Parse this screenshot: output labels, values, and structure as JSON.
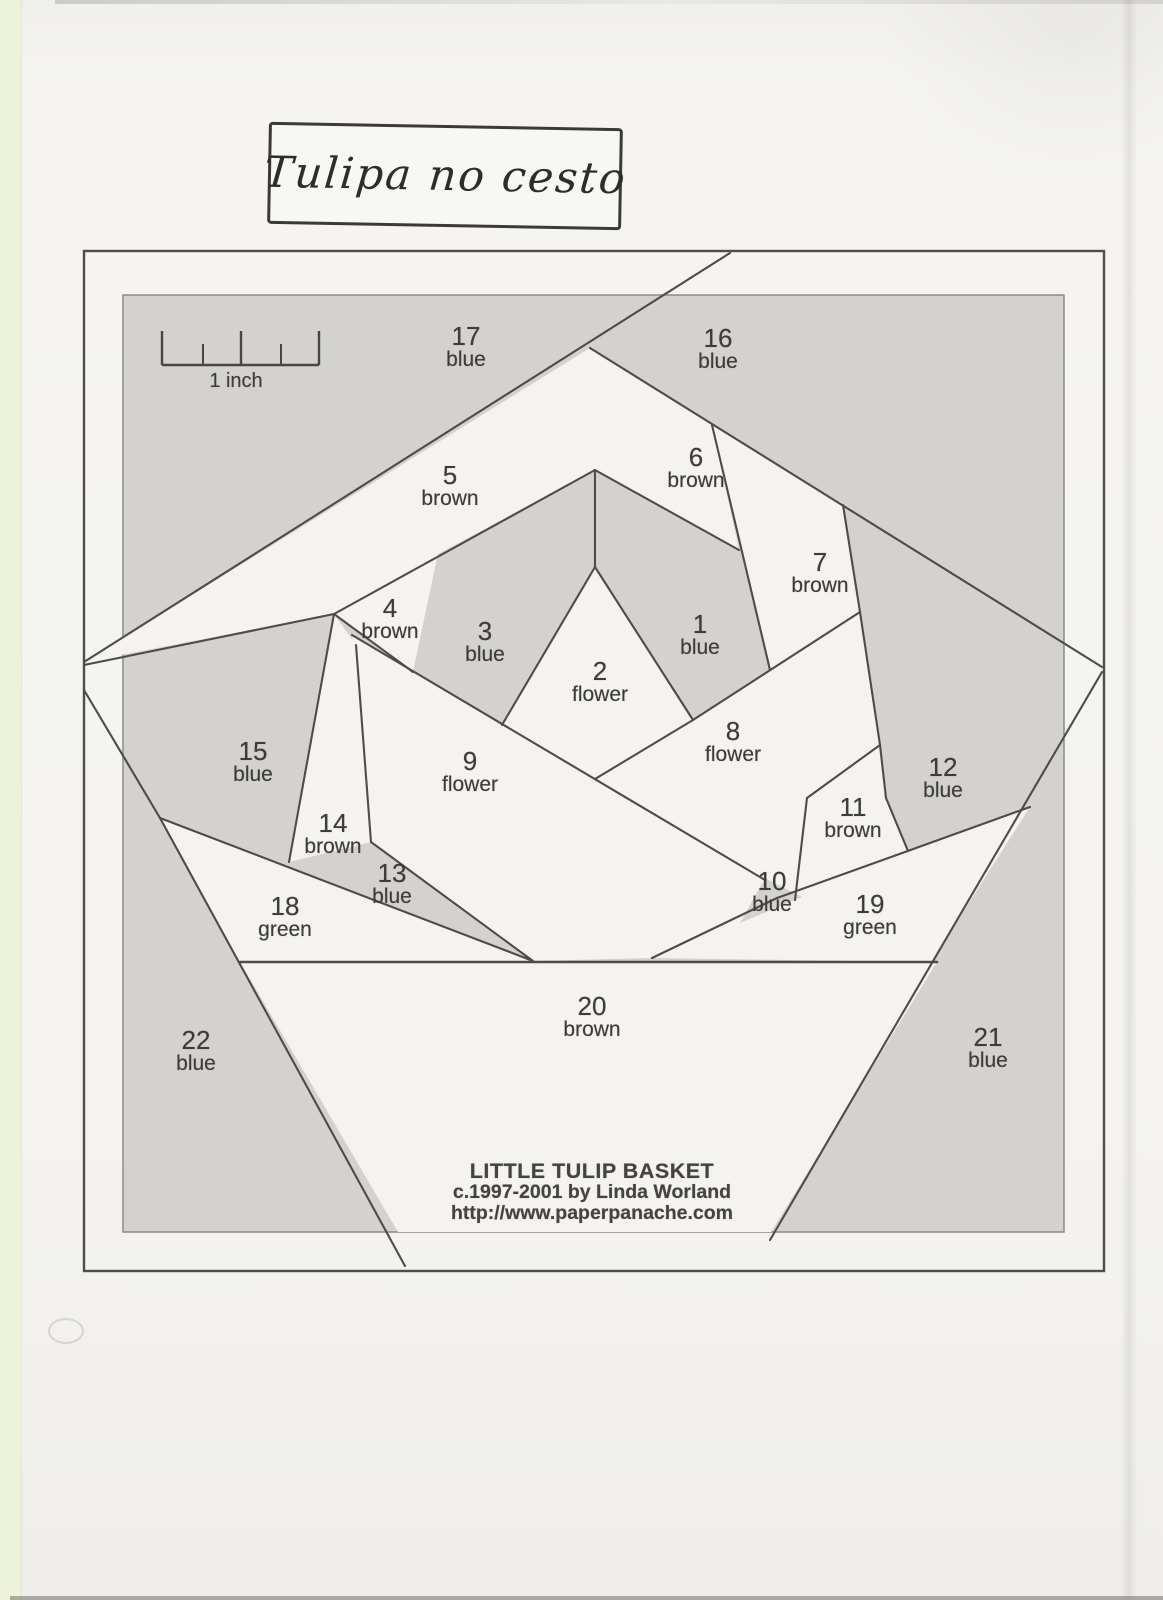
{
  "title": "Tulipa no cesto",
  "scale": {
    "label": "1 inch"
  },
  "footer": {
    "line1": "LITTLE TULIP BASKET",
    "line2": "c.1997-2001 by Linda Worland",
    "line3": "http://www.paperpanache.com"
  },
  "pieces": [
    {
      "num": "1",
      "color": "blue"
    },
    {
      "num": "2",
      "color": "flower"
    },
    {
      "num": "3",
      "color": "blue"
    },
    {
      "num": "4",
      "color": "brown"
    },
    {
      "num": "5",
      "color": "brown"
    },
    {
      "num": "6",
      "color": "brown"
    },
    {
      "num": "7",
      "color": "brown"
    },
    {
      "num": "8",
      "color": "flower"
    },
    {
      "num": "9",
      "color": "flower"
    },
    {
      "num": "10",
      "color": "blue"
    },
    {
      "num": "11",
      "color": "brown"
    },
    {
      "num": "12",
      "color": "blue"
    },
    {
      "num": "13",
      "color": "blue"
    },
    {
      "num": "14",
      "color": "brown"
    },
    {
      "num": "15",
      "color": "blue"
    },
    {
      "num": "16",
      "color": "blue"
    },
    {
      "num": "17",
      "color": "blue"
    },
    {
      "num": "18",
      "color": "green"
    },
    {
      "num": "19",
      "color": "green"
    },
    {
      "num": "20",
      "color": "brown"
    },
    {
      "num": "21",
      "color": "blue"
    },
    {
      "num": "22",
      "color": "blue"
    }
  ],
  "colors": {
    "paper": "#f4f3ef",
    "shaded_panel": "#d3d2ce",
    "ink_line": "#4f4c47",
    "label_text": "#3e3c36",
    "scan_edge_strip_green": "#edf2da"
  }
}
